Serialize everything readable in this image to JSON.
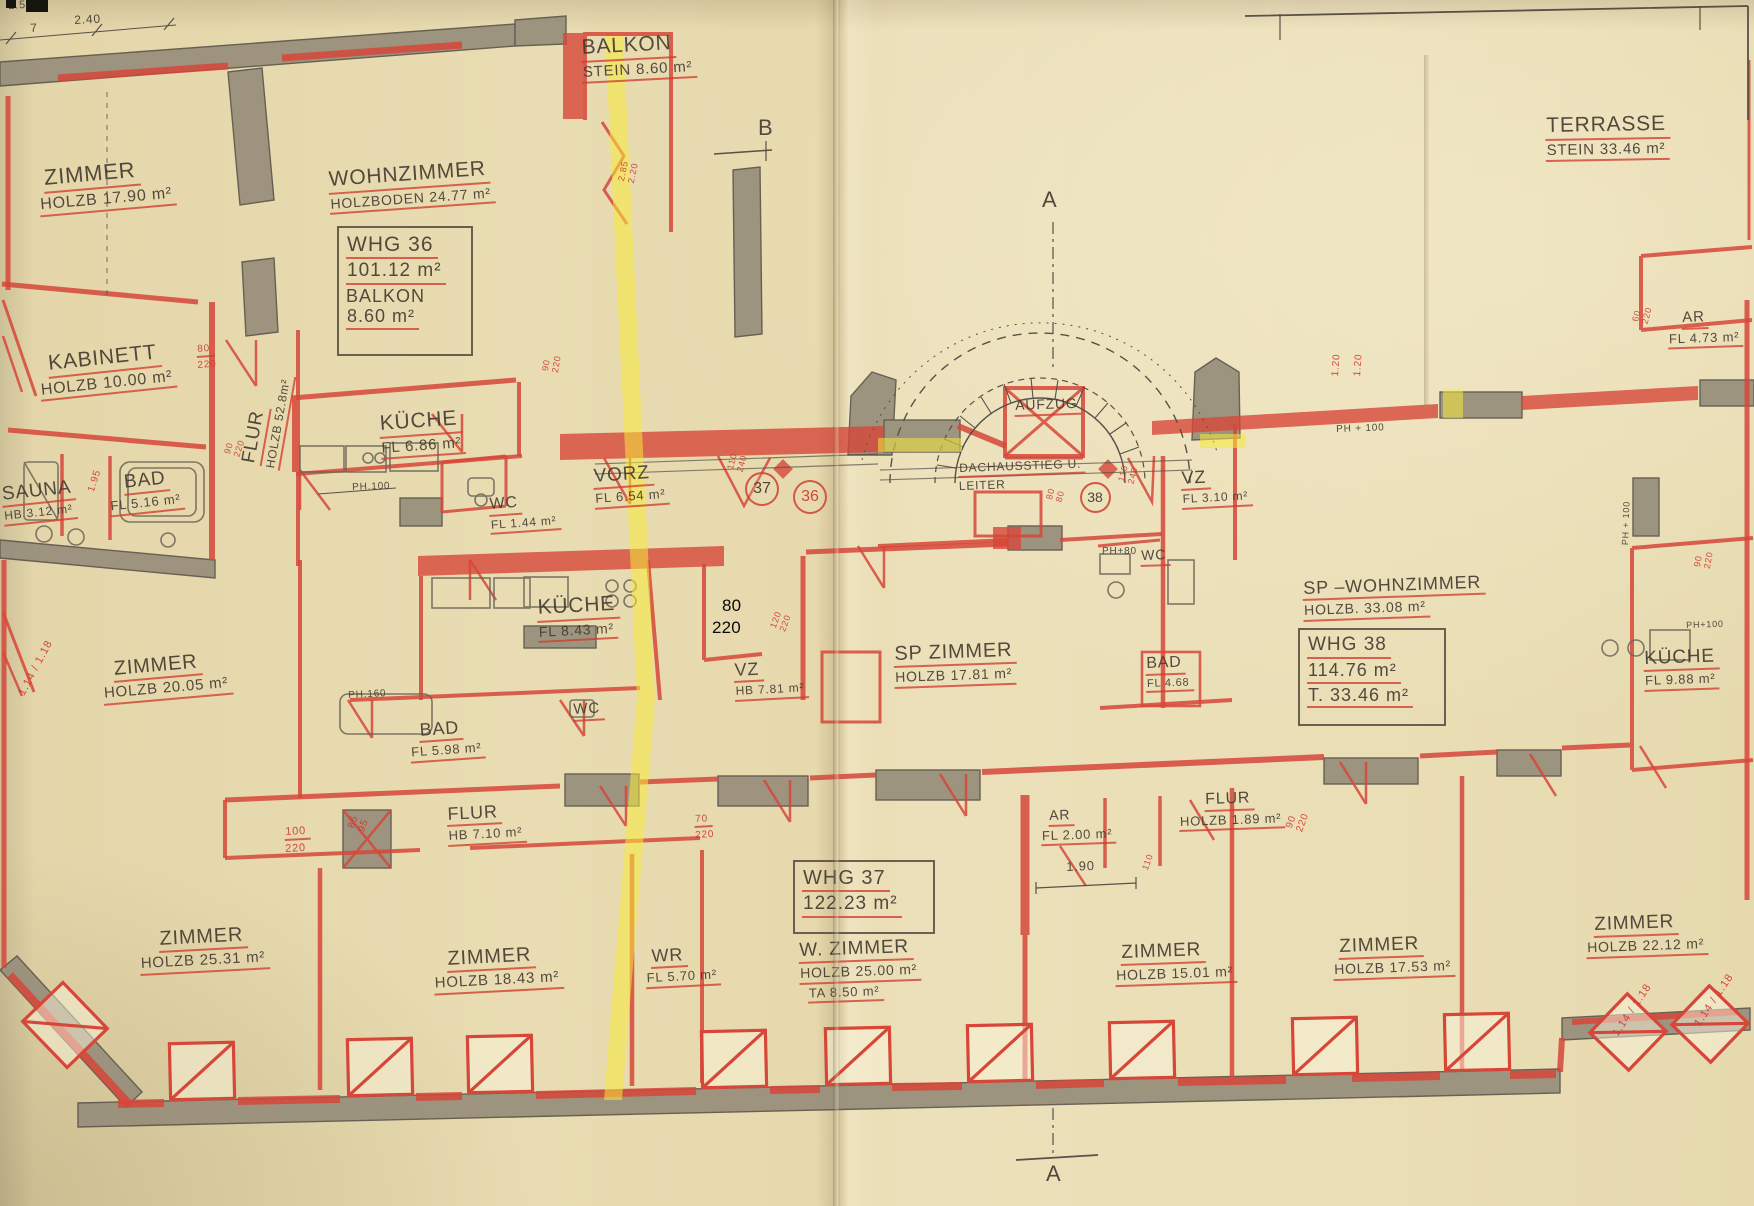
{
  "document": {
    "kind": "scanned architectural floor plan",
    "language": "de",
    "units_note": "m²"
  },
  "colors": {
    "paper": "#e8dbb0",
    "ink": "#46403a",
    "red": "#d6473a",
    "wall_gray": "#978e7b",
    "highlight_yellow": "#f6e93d",
    "annotation_black": "#000000"
  },
  "apartment_boxes": [
    {
      "id": "whg36",
      "x": 337,
      "y": 226,
      "w": 118,
      "h": 118,
      "lines": [
        {
          "t": "WHG 36",
          "s": 21,
          "u": 1
        },
        {
          "t": "101.12  m²",
          "s": 19,
          "u": 1
        },
        {
          "t": "BALKON",
          "s": 18,
          "u": 0
        },
        {
          "t": "8.60 m²",
          "s": 18,
          "u": 1
        }
      ]
    },
    {
      "id": "whg37",
      "x": 793,
      "y": 860,
      "w": 124,
      "h": 62,
      "lines": [
        {
          "t": "WHG 37",
          "s": 20,
          "u": 1
        },
        {
          "t": "122.23 m²",
          "s": 19,
          "u": 1
        }
      ]
    },
    {
      "id": "whg38",
      "x": 1298,
      "y": 628,
      "w": 130,
      "h": 86,
      "lines": [
        {
          "t": "WHG 38",
          "s": 19,
          "u": 1
        },
        {
          "t": "114.76 m²",
          "s": 18,
          "u": 1
        },
        {
          "t": "T. 33.46 m²",
          "s": 18,
          "u": 1
        }
      ]
    }
  ],
  "unit_circles": [
    {
      "t": "37",
      "x": 760,
      "y": 487,
      "d": 30,
      "c": "ink"
    },
    {
      "t": "36",
      "x": 808,
      "y": 495,
      "d": 30,
      "c": "red"
    },
    {
      "t": "38",
      "x": 1093,
      "y": 495,
      "d": 27,
      "c": "ink"
    }
  ],
  "labels": [
    {
      "n": "dim-250",
      "x": 8,
      "y": 0,
      "r": -3,
      "lines": [
        {
          "t": "2.50",
          "s": 11
        }
      ]
    },
    {
      "n": "dim-7",
      "x": 30,
      "y": 22,
      "r": -3,
      "lines": [
        {
          "t": "7",
          "s": 12
        }
      ]
    },
    {
      "n": "dim-240",
      "x": 74,
      "y": 14,
      "r": -3,
      "lines": [
        {
          "t": "2.40",
          "s": 12
        }
      ]
    },
    {
      "n": "room-zimmer-1790",
      "x": 42,
      "y": 166,
      "r": -5,
      "lines": [
        {
          "t": "ZIMMER",
          "s": 22,
          "u": 1
        },
        {
          "t": "HOLZB 17.90  m²",
          "s": 16,
          "u": 1,
          "dx": -6
        }
      ]
    },
    {
      "n": "room-balkon",
      "x": 580,
      "y": 36,
      "r": -3,
      "lines": [
        {
          "t": "BALKON",
          "s": 21,
          "u": 1
        },
        {
          "t": "STEIN 8.60 m²",
          "s": 15,
          "u": 1
        }
      ]
    },
    {
      "n": "room-wohnzimmer",
      "x": 327,
      "y": 168,
      "r": -4,
      "lines": [
        {
          "t": "WOHNZIMMER",
          "s": 21,
          "u": 1
        },
        {
          "t": "HOLZBODEN 24.77 m²",
          "s": 14,
          "u": 1
        }
      ]
    },
    {
      "n": "room-kabinett",
      "x": 46,
      "y": 352,
      "r": -6,
      "lines": [
        {
          "t": "KABINETT",
          "s": 21,
          "u": 1
        },
        {
          "t": "HOLZB 10.00 m²",
          "s": 16,
          "u": 1,
          "dx": -10
        }
      ]
    },
    {
      "n": "dim-80-220-a",
      "x": 196,
      "y": 344,
      "r": -4,
      "lines": [
        {
          "t": "80",
          "s": 10,
          "c": "red",
          "u": 1
        },
        {
          "t": "220",
          "s": 10,
          "c": "red"
        }
      ]
    },
    {
      "n": "room-sauna",
      "x": 0,
      "y": 484,
      "r": -6,
      "lines": [
        {
          "t": "SAUNA",
          "s": 19,
          "u": 1
        },
        {
          "t": "HB 3.12 m²",
          "s": 12,
          "u": 1
        }
      ]
    },
    {
      "n": "room-bad-516",
      "x": 122,
      "y": 472,
      "r": -6,
      "lines": [
        {
          "t": "BAD",
          "s": 19,
          "u": 1
        },
        {
          "t": "FL 5.16 m²",
          "s": 13,
          "u": 1,
          "dx": -16
        }
      ]
    },
    {
      "n": "dim-195",
      "x": 86,
      "y": 490,
      "r": -72,
      "lines": [
        {
          "t": "1.95",
          "s": 10,
          "c": "red"
        }
      ]
    },
    {
      "n": "dim-90-220-a",
      "x": 222,
      "y": 452,
      "r": -72,
      "lines": [
        {
          "t": "90",
          "s": 9,
          "c": "red"
        },
        {
          "t": "220",
          "s": 9,
          "c": "red"
        }
      ]
    },
    {
      "n": "room-flur-528",
      "x": 238,
      "y": 462,
      "r": -80,
      "lines": [
        {
          "t": "FLUR",
          "s": 19,
          "u": 1
        }
      ]
    },
    {
      "n": "room-flur-528-sub",
      "x": 264,
      "y": 468,
      "r": -80,
      "lines": [
        {
          "t": "HOLZB 52.8m²",
          "s": 12,
          "u": 1
        }
      ]
    },
    {
      "n": "room-kueche-686",
      "x": 378,
      "y": 412,
      "r": -4,
      "lines": [
        {
          "t": "KÜCHE",
          "s": 21,
          "u": 1
        },
        {
          "t": "FL 6.86  m²",
          "s": 15,
          "u": 1
        }
      ]
    },
    {
      "n": "note-ph100-a",
      "x": 352,
      "y": 482,
      "r": -2,
      "lines": [
        {
          "t": "PH.100",
          "s": 10
        }
      ]
    },
    {
      "n": "dim-90-220-b",
      "x": 540,
      "y": 370,
      "r": -80,
      "lines": [
        {
          "t": "90",
          "s": 9,
          "c": "red"
        },
        {
          "t": "220",
          "s": 9,
          "c": "red"
        }
      ]
    },
    {
      "n": "dim-285-220",
      "x": 616,
      "y": 180,
      "r": -78,
      "lines": [
        {
          "t": "2.85",
          "s": 9,
          "c": "red"
        },
        {
          "t": "2.20",
          "s": 9,
          "c": "red"
        }
      ]
    },
    {
      "n": "room-vorz",
      "x": 592,
      "y": 466,
      "r": -4,
      "lines": [
        {
          "t": "VORZ",
          "s": 19,
          "u": 1
        },
        {
          "t": "FL 6.54 m²",
          "s": 13,
          "u": 1
        }
      ]
    },
    {
      "n": "room-wc-144",
      "x": 488,
      "y": 496,
      "r": -4,
      "lines": [
        {
          "t": "WC",
          "s": 16,
          "u": 1
        },
        {
          "t": "FL 1.44 m²",
          "s": 12,
          "u": 1
        }
      ]
    },
    {
      "n": "dim-110-240-a",
      "x": 725,
      "y": 468,
      "r": -75,
      "lines": [
        {
          "t": "110",
          "s": 9,
          "c": "red"
        },
        {
          "t": "240",
          "s": 9,
          "c": "red"
        }
      ]
    },
    {
      "n": "room-kueche-843",
      "x": 536,
      "y": 596,
      "r": -3,
      "lines": [
        {
          "t": "KÜCHE",
          "s": 21,
          "u": 1
        },
        {
          "t": "FL 8.43 m²",
          "s": 14,
          "u": 1
        }
      ]
    },
    {
      "n": "note-ph160",
      "x": 348,
      "y": 690,
      "r": -3,
      "lines": [
        {
          "t": "PH.160",
          "s": 10
        }
      ]
    },
    {
      "n": "room-zimmer-2005",
      "x": 112,
      "y": 658,
      "r": -5,
      "lines": [
        {
          "t": "ZIMMER",
          "s": 20,
          "u": 1
        },
        {
          "t": "HOLZB 20.05 m²",
          "s": 15,
          "u": 1,
          "dx": -12
        }
      ]
    },
    {
      "n": "dim-114-118-a",
      "x": 16,
      "y": 692,
      "r": -62,
      "lines": [
        {
          "t": "1.14 / 1.18",
          "s": 11,
          "c": "red"
        }
      ]
    },
    {
      "n": "room-bad-598",
      "x": 418,
      "y": 720,
      "r": -4,
      "lines": [
        {
          "t": "BAD",
          "s": 18,
          "u": 1
        },
        {
          "t": "FL 5.98 m²",
          "s": 13,
          "u": 1,
          "dx": -10
        }
      ]
    },
    {
      "n": "room-wc-small",
      "x": 572,
      "y": 702,
      "r": -3,
      "lines": [
        {
          "t": "WC",
          "s": 15,
          "u": 1
        }
      ]
    },
    {
      "n": "room-vz-781",
      "x": 733,
      "y": 660,
      "r": -3,
      "lines": [
        {
          "t": "VZ",
          "s": 18,
          "u": 1
        },
        {
          "t": "HB 7.81 m²",
          "s": 12,
          "u": 1
        }
      ]
    },
    {
      "n": "dim-120-220",
      "x": 768,
      "y": 626,
      "r": -70,
      "lines": [
        {
          "t": "120",
          "s": 9,
          "c": "red"
        },
        {
          "t": "220",
          "s": 9,
          "c": "red"
        }
      ]
    },
    {
      "n": "room-sp-zimmer",
      "x": 893,
      "y": 643,
      "r": -2,
      "lines": [
        {
          "t": "SP ZIMMER",
          "s": 20,
          "u": 1
        },
        {
          "t": "HOLZB  17.81 m²",
          "s": 14,
          "u": 1
        }
      ]
    },
    {
      "n": "room-aufzug",
      "x": 1014,
      "y": 398,
      "r": -2,
      "lines": [
        {
          "t": "AUFZUG",
          "s": 14,
          "u": 1
        }
      ]
    },
    {
      "n": "note-dachausstieg",
      "x": 958,
      "y": 462,
      "r": -2,
      "lines": [
        {
          "t": "DACHAUSSTIEG U.",
          "s": 12,
          "u": 1
        },
        {
          "t": "LEITER",
          "s": 12
        }
      ]
    },
    {
      "n": "dim-80-80",
      "x": 1044,
      "y": 498,
      "r": -75,
      "lines": [
        {
          "t": "80",
          "s": 9,
          "c": "red"
        },
        {
          "t": "80",
          "s": 9,
          "c": "red"
        }
      ]
    },
    {
      "n": "dim-110-240-b",
      "x": 1116,
      "y": 480,
      "r": -75,
      "lines": [
        {
          "t": "110",
          "s": 9,
          "c": "red"
        },
        {
          "t": "240",
          "s": 9,
          "c": "red"
        }
      ]
    },
    {
      "n": "room-vz-310",
      "x": 1180,
      "y": 468,
      "r": -3,
      "lines": [
        {
          "t": "VZ",
          "s": 18,
          "u": 1
        },
        {
          "t": "FL 3.10 m²",
          "s": 12,
          "u": 1
        }
      ]
    },
    {
      "n": "note-ph80",
      "x": 1102,
      "y": 546,
      "r": 0,
      "lines": [
        {
          "t": "PH+80",
          "s": 10
        }
      ]
    },
    {
      "n": "room-wc-38",
      "x": 1140,
      "y": 548,
      "r": -2,
      "lines": [
        {
          "t": "WC",
          "s": 14,
          "u": 1
        }
      ]
    },
    {
      "n": "dim-120-a",
      "x": 1330,
      "y": 376,
      "r": -86,
      "lines": [
        {
          "t": "1.20",
          "s": 10,
          "c": "red"
        }
      ]
    },
    {
      "n": "dim-120-b",
      "x": 1352,
      "y": 376,
      "r": -86,
      "lines": [
        {
          "t": "1.20",
          "s": 10,
          "c": "red"
        }
      ]
    },
    {
      "n": "note-ph100-b",
      "x": 1336,
      "y": 424,
      "r": -2,
      "lines": [
        {
          "t": "PH + 100",
          "s": 10
        }
      ]
    },
    {
      "n": "room-sp-wohnzimmer",
      "x": 1302,
      "y": 578,
      "r": -2,
      "lines": [
        {
          "t": "SP –WOHNZIMMER",
          "s": 18,
          "u": 1
        },
        {
          "t": "HOLZB.  33.08 m²",
          "s": 14,
          "u": 1
        }
      ]
    },
    {
      "n": "room-bad-468",
      "x": 1145,
      "y": 655,
      "r": -2,
      "lines": [
        {
          "t": "BAD",
          "s": 16,
          "u": 1
        },
        {
          "t": "FL 4.68",
          "s": 11,
          "u": 1
        }
      ]
    },
    {
      "n": "note-ph100-c",
      "x": 1620,
      "y": 545,
      "r": -88,
      "lines": [
        {
          "t": "PH + 100",
          "s": 9
        }
      ]
    },
    {
      "n": "room-kueche-988",
      "x": 1643,
      "y": 648,
      "r": -2,
      "lines": [
        {
          "t": "KÜCHE",
          "s": 19,
          "u": 1
        },
        {
          "t": "FL 9.88 m²",
          "s": 13,
          "u": 1
        }
      ]
    },
    {
      "n": "dim-90-220-c",
      "x": 1692,
      "y": 566,
      "r": -80,
      "lines": [
        {
          "t": "90",
          "s": 9,
          "c": "red"
        },
        {
          "t": "220",
          "s": 9,
          "c": "red"
        }
      ]
    },
    {
      "n": "note-ph100-d",
      "x": 1686,
      "y": 620,
      "r": -2,
      "lines": [
        {
          "t": "PH+100",
          "s": 9
        }
      ]
    },
    {
      "n": "room-terrasse",
      "x": 1545,
      "y": 114,
      "r": -1,
      "lines": [
        {
          "t": "TERRASSE",
          "s": 21,
          "u": 1
        },
        {
          "t": "STEIN  33.46 m²",
          "s": 15,
          "u": 1
        }
      ]
    },
    {
      "n": "room-ar-473",
      "x": 1681,
      "y": 310,
      "r": -2,
      "lines": [
        {
          "t": "AR",
          "s": 15,
          "u": 1
        },
        {
          "t": "FL 4.73 m²",
          "s": 13,
          "u": 1,
          "dx": -14
        }
      ]
    },
    {
      "n": "dim-60-220",
      "x": 1630,
      "y": 320,
      "r": -75,
      "lines": [
        {
          "t": "60",
          "s": 9,
          "c": "red"
        },
        {
          "t": "220",
          "s": 9,
          "c": "red"
        }
      ]
    },
    {
      "n": "room-flur-710",
      "x": 446,
      "y": 804,
      "r": -3,
      "lines": [
        {
          "t": "FLUR",
          "s": 18,
          "u": 1
        },
        {
          "t": "HB 7.10 m²",
          "s": 13,
          "u": 1
        }
      ]
    },
    {
      "n": "dim-100-220",
      "x": 284,
      "y": 826,
      "r": -3,
      "lines": [
        {
          "t": "100",
          "s": 11,
          "c": "red",
          "u": 1
        },
        {
          "t": "220",
          "s": 11,
          "c": "red"
        }
      ]
    },
    {
      "n": "dim-85-95",
      "x": 346,
      "y": 826,
      "r": -70,
      "lines": [
        {
          "t": "85",
          "s": 10,
          "c": "red"
        },
        {
          "t": "95",
          "s": 10,
          "c": "red"
        }
      ]
    },
    {
      "n": "dim-70-220",
      "x": 694,
      "y": 814,
      "r": -3,
      "lines": [
        {
          "t": "70",
          "s": 10,
          "c": "red",
          "u": 1
        },
        {
          "t": "220",
          "s": 10,
          "c": "red"
        }
      ]
    },
    {
      "n": "room-ar-200",
      "x": 1048,
      "y": 808,
      "r": -2,
      "lines": [
        {
          "t": "AR",
          "s": 14,
          "u": 1
        },
        {
          "t": "FL 2.00 m²",
          "s": 13,
          "u": 1,
          "dx": -8
        }
      ]
    },
    {
      "n": "room-flur-189",
      "x": 1178,
      "y": 792,
      "r": -2,
      "lines": [
        {
          "t": "FLUR",
          "s": 16,
          "u": 1,
          "dx": 26
        },
        {
          "t": "HOLZB 1.89 m²",
          "s": 13,
          "u": 1
        }
      ]
    },
    {
      "n": "dim-190",
      "x": 1066,
      "y": 860,
      "r": -2,
      "lines": [
        {
          "t": "1.90",
          "s": 13
        }
      ]
    },
    {
      "n": "dim-110",
      "x": 1140,
      "y": 868,
      "r": -70,
      "lines": [
        {
          "t": "110",
          "s": 9,
          "c": "red"
        }
      ]
    },
    {
      "n": "dim-90-220-d",
      "x": 1284,
      "y": 826,
      "r": -70,
      "lines": [
        {
          "t": "90",
          "s": 10,
          "c": "red"
        },
        {
          "t": "220",
          "s": 10,
          "c": "red"
        }
      ]
    },
    {
      "n": "room-zimmer-2531",
      "x": 158,
      "y": 928,
      "r": -3,
      "lines": [
        {
          "t": "ZIMMER",
          "s": 20,
          "u": 1
        },
        {
          "t": "HOLZB  25.31 m²",
          "s": 15,
          "u": 1,
          "dx": -20
        }
      ]
    },
    {
      "n": "room-zimmer-1843",
      "x": 446,
      "y": 948,
      "r": -3,
      "lines": [
        {
          "t": "ZIMMER",
          "s": 20,
          "u": 1
        },
        {
          "t": "HOLZB  18.43 m²",
          "s": 15,
          "u": 1,
          "dx": -14
        }
      ]
    },
    {
      "n": "room-wr",
      "x": 650,
      "y": 946,
      "r": -3,
      "lines": [
        {
          "t": "WR",
          "s": 18,
          "u": 1
        },
        {
          "t": "FL 5.70 m²",
          "s": 13,
          "u": 1,
          "dx": -6
        }
      ]
    },
    {
      "n": "room-w-zimmer",
      "x": 798,
      "y": 940,
      "r": -2,
      "lines": [
        {
          "t": "W. ZIMMER",
          "s": 19,
          "u": 1
        },
        {
          "t": "HOLZB 25.00 m²",
          "s": 14,
          "u": 1
        },
        {
          "t": "TA  8.50 m²",
          "s": 13,
          "u": 1,
          "dx": 8
        }
      ]
    },
    {
      "n": "room-zimmer-1501",
      "x": 1120,
      "y": 942,
      "r": -2,
      "lines": [
        {
          "t": "ZIMMER",
          "s": 19,
          "u": 1
        },
        {
          "t": "HOLZB 15.01 m²",
          "s": 14,
          "u": 1,
          "dx": -6
        }
      ]
    },
    {
      "n": "room-zimmer-1753",
      "x": 1338,
      "y": 936,
      "r": -2,
      "lines": [
        {
          "t": "ZIMMER",
          "s": 19,
          "u": 1
        },
        {
          "t": "HOLZB 17.53 m²",
          "s": 14,
          "u": 1,
          "dx": -6
        }
      ]
    },
    {
      "n": "room-zimmer-2212",
      "x": 1593,
      "y": 914,
      "r": -2,
      "lines": [
        {
          "t": "ZIMMER",
          "s": 19,
          "u": 1
        },
        {
          "t": "HOLZB 22.12 m²",
          "s": 14,
          "u": 1,
          "dx": -8
        }
      ]
    },
    {
      "n": "dim-114-118-b",
      "x": 1610,
      "y": 1032,
      "r": -56,
      "lines": [
        {
          "t": "1.14 / 1.18",
          "s": 11,
          "c": "red"
        }
      ]
    },
    {
      "n": "dim-114-118-c",
      "x": 1692,
      "y": 1022,
      "r": -56,
      "lines": [
        {
          "t": "1.14 / 1.18",
          "s": 11,
          "c": "red"
        }
      ]
    },
    {
      "n": "note-80-black",
      "x": 722,
      "y": 596,
      "r": 0,
      "lines": [
        {
          "t": "80",
          "s": 17,
          "c": "black"
        }
      ]
    },
    {
      "n": "note-220-black",
      "x": 712,
      "y": 618,
      "r": 0,
      "lines": [
        {
          "t": "220",
          "s": 17,
          "c": "black"
        }
      ]
    },
    {
      "n": "marker-a-top",
      "x": 1042,
      "y": 188,
      "r": 0,
      "lines": [
        {
          "t": "A",
          "s": 22
        }
      ]
    },
    {
      "n": "marker-b",
      "x": 758,
      "y": 116,
      "r": 0,
      "lines": [
        {
          "t": "B",
          "s": 22
        }
      ]
    },
    {
      "n": "marker-a-bottom",
      "x": 1046,
      "y": 1162,
      "r": 0,
      "lines": [
        {
          "t": "A",
          "s": 22
        }
      ]
    }
  ]
}
